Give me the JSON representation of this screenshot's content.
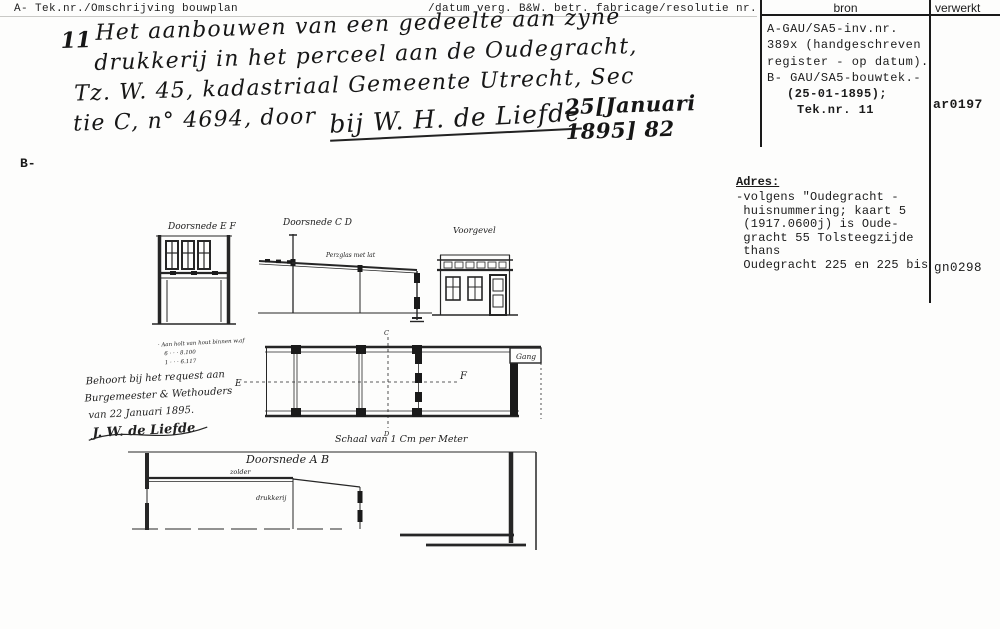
{
  "header": {
    "left": "A- Tek.nr./Omschrijving bouwplan",
    "middle": "/datum verg. B&W. betr. fabricage/resolutie nr."
  },
  "bron_table": {
    "col_bron": "bron",
    "col_verwerkt": "verwerkt",
    "lines": [
      "A-GAU/SA5-inv.nr.",
      "389x (handgeschreven",
      "register - op datum).",
      "B- GAU/SA5-bouwtek.-",
      "(25-01-1895);",
      "Tek.nr. 11"
    ],
    "code": "ar0197"
  },
  "description": {
    "number": "11",
    "lines": [
      "Het aanbouwen van een gedeelte aan zyne",
      "drukkerij in het perceel aan de Oudegracht,",
      "Tz. W. 45, kadastriaal Gemeente Utrecht, Sec",
      "tie C, n° 4694, door"
    ],
    "signature": "bij W. H. de Liefde",
    "date": "25[Januari 1895] 82"
  },
  "section_label": "B-",
  "adres": {
    "title": "Adres:",
    "lines": [
      "-volgens \"Oudegracht -",
      " huisnummering; kaart 5",
      " (1917.0600j) is Oude-",
      " gracht 55 Tolsteegzijde",
      " thans",
      " Oudegracht 225 en 225 bis"
    ],
    "code": "gn0298"
  },
  "drawings": {
    "labels": {
      "doorsnede_ef": "Doorsnede E F",
      "doorsnede_cd": "Doorsnede C D",
      "voorgevel": "Voorgevel",
      "doorsnede_ab": "Doorsnede A B"
    },
    "roof_note": "Perzglas met lat",
    "gang": "Gang",
    "scale_caption": "Schaal van 1 Cm per Meter",
    "markers": {
      "c": "C",
      "d": "D",
      "e": "E",
      "f": "F"
    },
    "ab_notes": {
      "upper": "zolder",
      "lower": "drukkerij"
    },
    "request_note": {
      "measurements": [
        "· Aan holt van hout binnen w.af",
        "6   ·   ·   ·   8.100",
        "1   ·   ·   ·   6.117"
      ],
      "lines": [
        "Behoort bij het request aan",
        "Burgemeester & Wethouders",
        "van 22 Januari 1895."
      ],
      "signature": "J. W. de Liefde"
    }
  }
}
